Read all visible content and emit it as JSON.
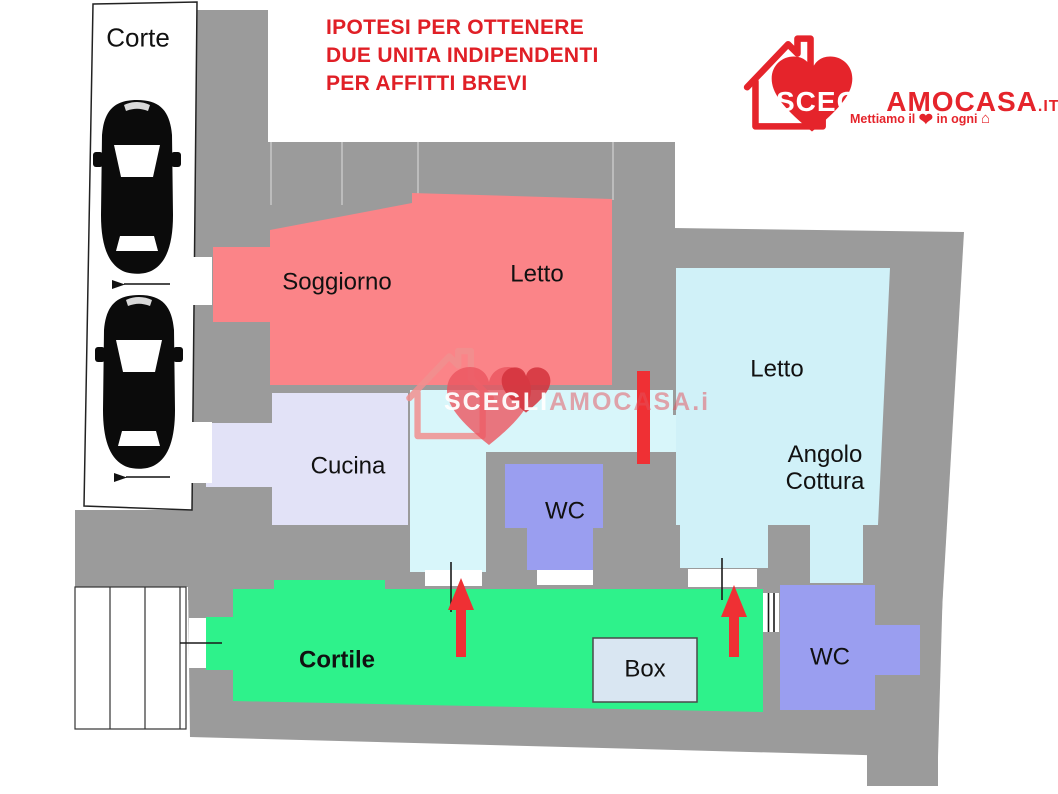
{
  "colors": {
    "wall": "#9B9B9B",
    "room_living": "#FB8488",
    "room_kitchen": "#E2E2F7",
    "room_hall": "#D8F6FA",
    "room_bed2": "#D0F1F8",
    "room_wc": "#9A9EF0",
    "courtyard": "#2EF28B",
    "box_fill": "#D9E6F2",
    "accent_red": "#EF3034",
    "title_red": "#E01F26",
    "brand_red": "#E5242B"
  },
  "title": {
    "lines": [
      "IPOTESI PER OTTENERE",
      "DUE UNITA INDIPENDENTI",
      "PER AFFITTI BREVI"
    ]
  },
  "logo": {
    "brand_part1": "SCEGLI",
    "brand_part2": "AMOCASA",
    "tld": ".IT",
    "registered": "®",
    "tagline_pre": "Mettiamo il",
    "tagline_post": "in ogni",
    "heart_glyph": "❤",
    "house_glyph": "⌂"
  },
  "watermark": {
    "part1": "SCEGLI",
    "part2": "AMOCASA.i"
  },
  "plan": {
    "labels": {
      "corte": "Corte",
      "soggiorno": "Soggiorno",
      "letto_sx": "Letto",
      "cucina": "Cucina",
      "wc_centro": "WC",
      "letto_dx": "Letto",
      "angolo_cottura": "Angolo Cottura",
      "cortile": "Cortile",
      "box": "Box",
      "wc_dx": "WC"
    }
  }
}
